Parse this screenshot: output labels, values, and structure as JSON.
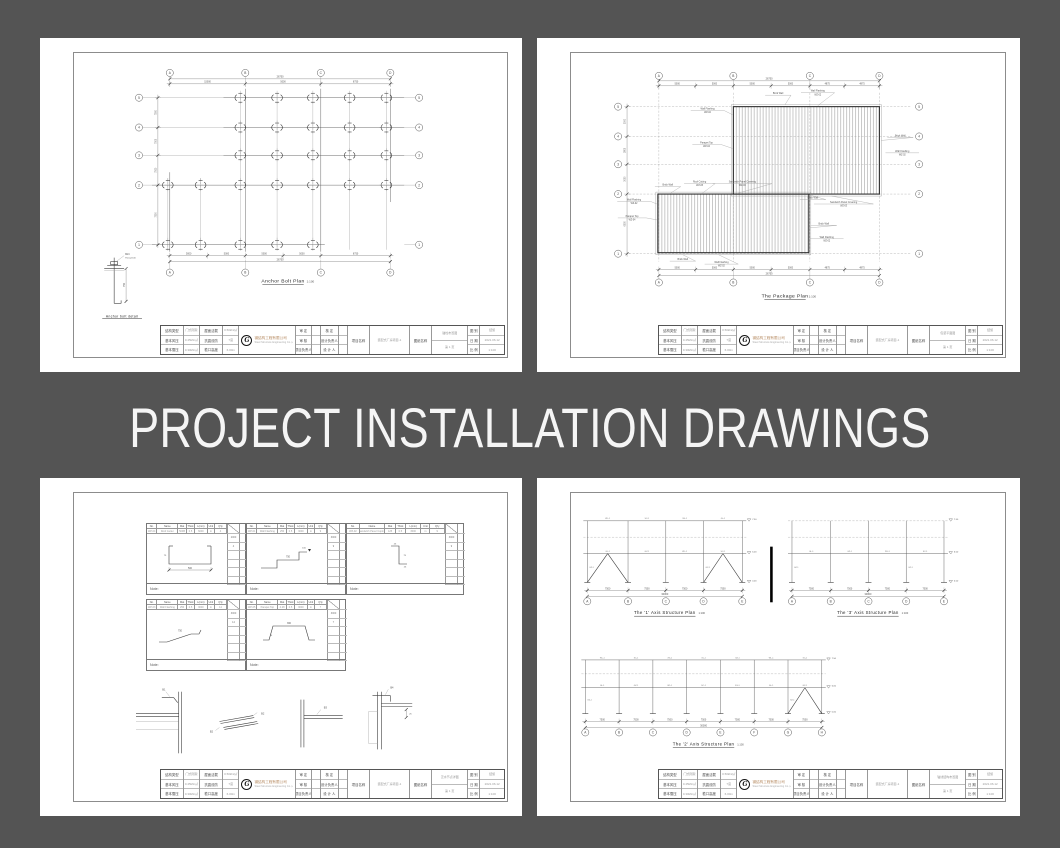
{
  "banner": {
    "text": "PROJECT INSTALLATION DRAWINGS"
  },
  "colors": {
    "background": "#545454",
    "paper": "#ffffff",
    "line": "#3d3d3d",
    "company_accent": "#b5895f"
  },
  "sheet_anchor": {
    "plan_title": "Anchor Bolt Plan",
    "plan_scale": "1:100",
    "detail_caption": "Anchor bolt detail",
    "detail_labels": [
      "M24",
      "Thread 100"
    ],
    "detail_dim": "750",
    "axes_top": [
      "A",
      "B",
      "C",
      "D"
    ],
    "axes_side": [
      "5",
      "4",
      "3",
      "2",
      "1"
    ],
    "dims_top": [
      "15000",
      "5000",
      "6750"
    ],
    "dim_total_top": "26750",
    "dims_bottom": [
      "5000",
      "5000",
      "5000",
      "5000",
      "6750"
    ],
    "dim_total_bottom": "26750",
    "dims_left": [
      "7500",
      "7500",
      "7500",
      "7500"
    ]
  },
  "sheet_package": {
    "plan_title": "The Package Plan",
    "plan_scale": "1:100",
    "axes_top": [
      "A",
      "B",
      "C",
      "D"
    ],
    "axes_side": [
      "5",
      "4",
      "3",
      "2",
      "1"
    ],
    "dims_top": [
      "5000",
      "5000",
      "5000",
      "5000",
      "4875",
      "4875"
    ],
    "dim_total_top": "26750",
    "dims_bottom": [
      "5000",
      "5000",
      "5000",
      "5000",
      "4875",
      "4875"
    ],
    "dim_total_bottom": "26750",
    "dims_side": [
      "3000",
      "2800",
      "3000",
      "6000"
    ],
    "labels": {
      "brick": {
        "t": "Brick Wall",
        "c": ""
      },
      "wf": {
        "t": "Wall Flashing",
        "c": "WZ-02"
      },
      "pt": {
        "t": "Parapet Top",
        "c": "WZ-04"
      },
      "rc": {
        "t": "Roof Cutting",
        "c": "WZ-05"
      },
      "sp": {
        "t": "Sandwich Panel Covering",
        "c": "WZ-03"
      }
    }
  },
  "sheet_details": {
    "note_label": "Note:",
    "header": [
      "No.",
      "Name",
      "Mat",
      "Thick",
      "L(mm)",
      "Unit",
      "Q'ty"
    ],
    "tables": [
      {
        "no": "WZ-04",
        "name": "Roof Gutter",
        "vals": [
          "500B",
          "0.5",
          "6000",
          "m",
          "4"
        ],
        "qty": [
          "2000",
          "4"
        ],
        "dims": [
          "500",
          "75"
        ]
      },
      {
        "no": "WZ-01",
        "name": "Wall Flashing",
        "vals": [
          "250",
          "0.5",
          "3000",
          "m",
          "9"
        ],
        "qty": [
          "3000",
          "9"
        ],
        "dims": [
          "750",
          "100"
        ]
      },
      {
        "no": "WZ-02",
        "name": "Sandwich Panel Coping",
        "vals": [
          "125",
          "0.5",
          "3000",
          "m",
          "9"
        ],
        "qty": [
          "3000",
          "9"
        ],
        "dims": [
          "25",
          "75"
        ]
      },
      {
        "no": "WZ-03",
        "name": "Wall Flashing",
        "vals": [
          "250",
          "0.5",
          "3000",
          "m",
          "14"
        ],
        "qty": [
          "3000",
          "14"
        ],
        "dims": [
          "750",
          ""
        ]
      },
      {
        "no": "WZ-05",
        "name": "Parapet Top",
        "vals": [
          "4.28",
          "0.5",
          "3000",
          "m",
          "7"
        ],
        "qty": [
          "3000",
          "7"
        ],
        "dims": [
          "360",
          "25"
        ]
      }
    ],
    "details": [
      "B1",
      "B2",
      "B3",
      "B4"
    ]
  },
  "sheet_structure": {
    "plans": [
      {
        "title": "The '1' Axis Structure Plan",
        "scale": "1:100"
      },
      {
        "title": "The '3' Axis Structure Plan",
        "scale": "1:100"
      },
      {
        "title": "The '2' Axis Structure Plan",
        "scale": "1:100"
      }
    ],
    "axes_letters": [
      "A",
      "B",
      "C",
      "D",
      "E",
      "F",
      "G",
      "H"
    ],
    "member_labels": [
      "GL-1",
      "GZ-1",
      "WL-1",
      "SC-1",
      "XG-1"
    ],
    "dims": [
      "7500",
      "7500",
      "7500",
      "7500",
      "7500",
      "7500",
      "7500"
    ],
    "dim_total": "30000",
    "levels": [
      "7.50",
      "6.00",
      "0.00"
    ]
  },
  "titleblock": {
    "logo_letter": "G",
    "company_cn": "钢结构工程有限公司",
    "company_en": "Steel Structure Engineering Co.,Ltd.",
    "grid1_labels": [
      "结构类型",
      "基本风压",
      "基本雪压"
    ],
    "grid1_values": [
      "门式刚架",
      "0.45kN/㎡",
      "0.30kN/㎡"
    ],
    "grid2_labels": [
      "屋面活载",
      "抗震设防",
      "檐口高度"
    ],
    "grid2_values": [
      "0.50kN/㎡",
      "7度",
      "6.00m"
    ],
    "sign_labels": [
      "审 定",
      "审 核",
      "项目负责人"
    ],
    "sign2_labels": [
      "核 定",
      "设计负责人",
      "设 计 人"
    ],
    "project_label": "项目名称",
    "project_value": "装配式厂房项目-1",
    "drawing_label": "图纸名称",
    "drawing_values": [
      "锚栓布置图",
      "包装平面图",
      "泛水节点详图",
      "轴线结构布置图"
    ],
    "page_label": "第 1 页",
    "meta_labels": [
      "图 别",
      "日 期",
      "比 例"
    ],
    "meta_values": [
      "结施",
      "2021.06.12",
      "1:100"
    ]
  }
}
